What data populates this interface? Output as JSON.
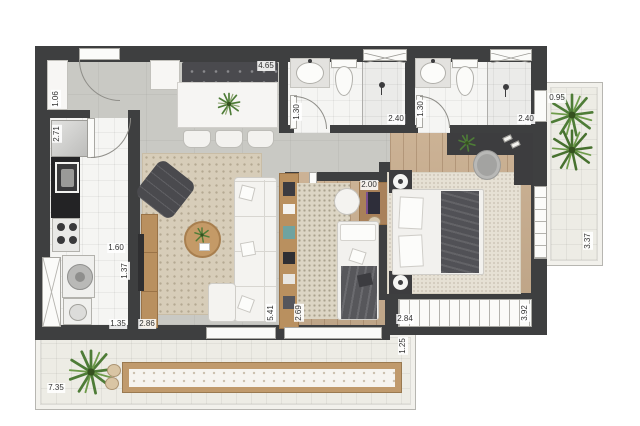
{
  "palette": {
    "wall": "#3e3f40",
    "wood": "#c9ae8f",
    "concrete": "#c9c9c4",
    "tile": "#f5f5f3",
    "balcony": "#edece5",
    "plant_dark": "#4e7c37",
    "plant_light": "#6f9c4b",
    "furniture_dark": "#4a4a4e",
    "furniture_wood": "#b9905f"
  },
  "dimensions": [
    {
      "id": "foyer-closet",
      "text": "1.06"
    },
    {
      "id": "kitchen-fridge-depth",
      "text": "2.71"
    },
    {
      "id": "dining-width",
      "text": "4.65"
    },
    {
      "id": "bath1-door",
      "text": "1.30"
    },
    {
      "id": "bath1-shower",
      "text": "2.40"
    },
    {
      "id": "bath2-door",
      "text": "1.30"
    },
    {
      "id": "bath2-shower",
      "text": "2.40"
    },
    {
      "id": "balcony-right-width",
      "text": "0.95"
    },
    {
      "id": "office-desk",
      "text": "2.00"
    },
    {
      "id": "kitchen-width",
      "text": "1.60"
    },
    {
      "id": "kitchen-depth",
      "text": "1.37"
    },
    {
      "id": "laundry-width",
      "text": "1.35"
    },
    {
      "id": "living-width",
      "text": "2.86"
    },
    {
      "id": "living-depth",
      "text": "5.41"
    },
    {
      "id": "office-width",
      "text": "2.69"
    },
    {
      "id": "bedroom-window-width",
      "text": "2.84"
    },
    {
      "id": "bedroom-depth",
      "text": "3.92"
    },
    {
      "id": "balcony-right-depth",
      "text": "3.37"
    },
    {
      "id": "balcony-bottom-depth",
      "text": "1.25"
    },
    {
      "id": "balcony-bottom-width",
      "text": "7.35"
    }
  ]
}
